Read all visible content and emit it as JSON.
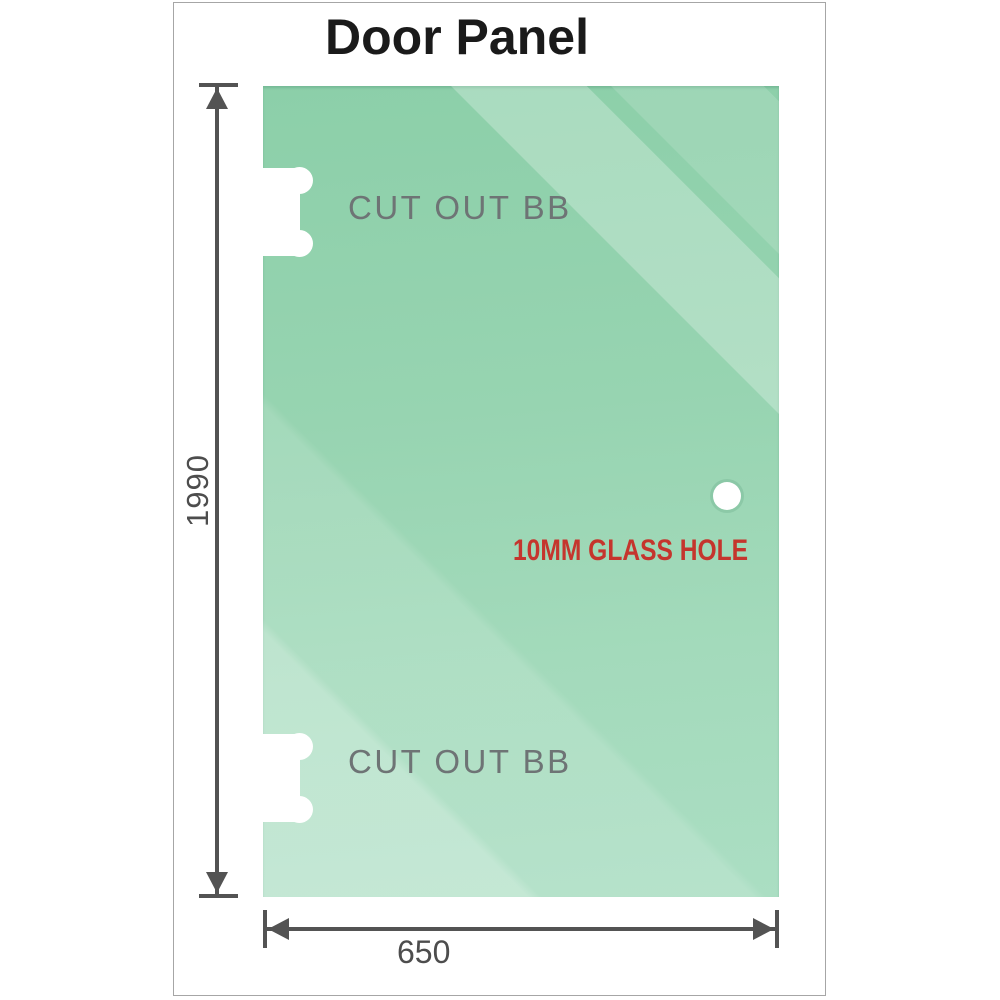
{
  "title": "Door Panel",
  "panel": {
    "cutout_top": {
      "label": "CUT OUT BB"
    },
    "cutout_bottom": {
      "label": "CUT OUT BB"
    },
    "hole": {
      "label": "10MM GLASS HOLE"
    }
  },
  "dimensions": {
    "height": {
      "value": "1990"
    },
    "width": {
      "value": "650"
    }
  },
  "colors": {
    "glass_base": "#9fd8b8",
    "glass_dark": "#8ccfa9",
    "glass_light": "#b6e2c9",
    "dimension_lines": "#535353",
    "dimension_text": "#4d4d4d",
    "cutout_label_text": "#6e7475",
    "hole_label_text": "#c5352d",
    "title_text": "#1a1a1a",
    "frame_border": "#a6a6a6"
  }
}
